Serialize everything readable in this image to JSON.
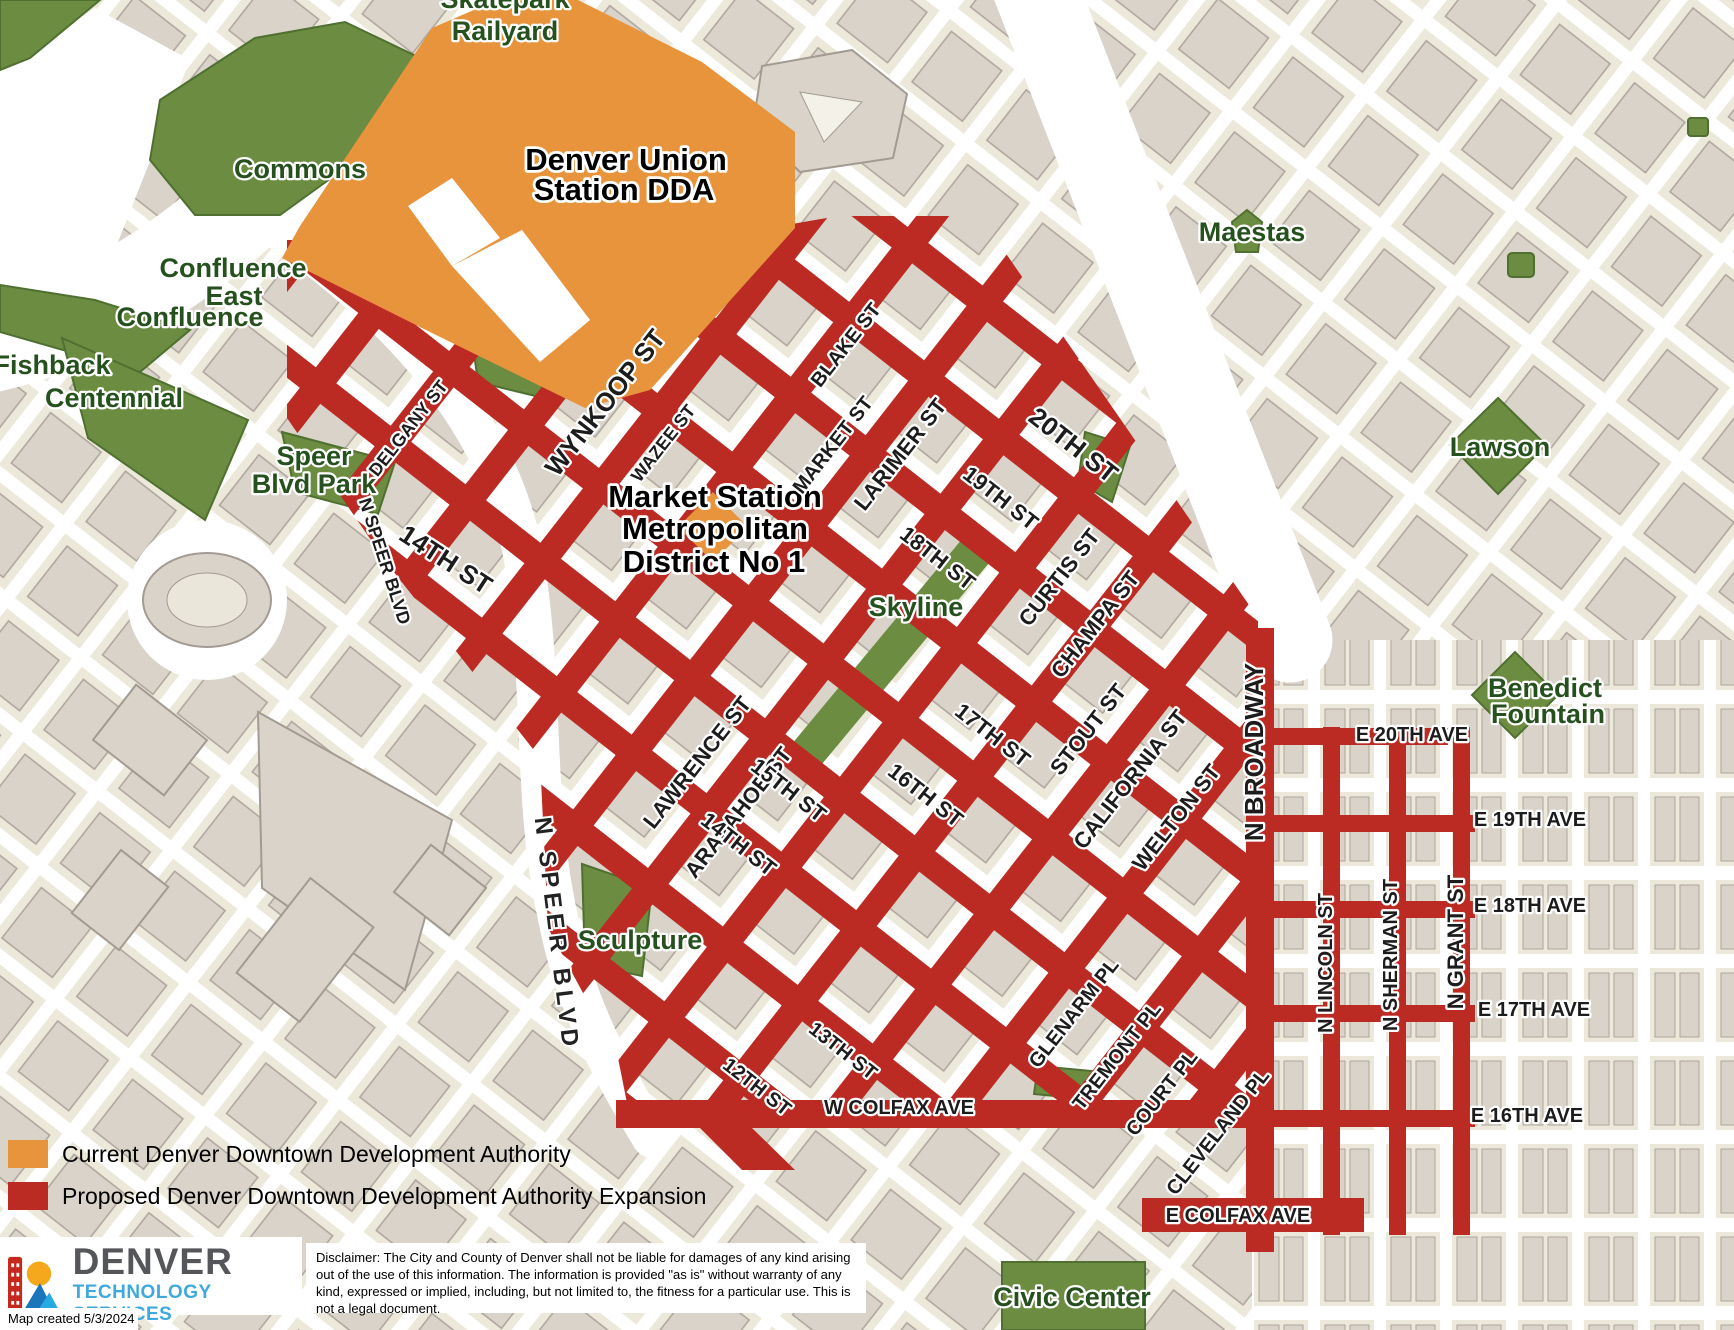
{
  "map": {
    "district_labels": [
      "Denver Union",
      "Station DDA",
      "Market Station",
      "Metropolitan",
      "District No 1"
    ],
    "area_labels": [
      "Skatepark",
      "Railyard",
      "Commons",
      "Confluence",
      "East",
      "Confluence",
      "Fishback",
      "Centennial",
      "Speer",
      "Blvd Park",
      "Maestas",
      "Lawson",
      "Benedict",
      "Fountain",
      "Skyline",
      "Sculpture",
      "Civic Center"
    ],
    "street_labels": [
      "DELGANY ST",
      "WYNKOOP ST",
      "WAZEE ST",
      "BLAKE ST",
      "MARKET ST",
      "LARIMER ST",
      "LAWRENCE ST",
      "ARAPAHOE ST",
      "CURTIS ST",
      "CHAMPA ST",
      "STOUT ST",
      "CALIFORNIA ST",
      "WELTON ST",
      "GLENARM PL",
      "TREMONT PL",
      "COURT PL",
      "CLEVELAND PL",
      "20TH ST",
      "19TH ST",
      "18TH ST",
      "17TH ST",
      "16TH ST",
      "15TH ST",
      "14TH ST",
      "13TH ST",
      "12TH ST",
      "14TH ST",
      "N SPEER BLVD",
      "W COLFAX AVE",
      "E COLFAX AVE",
      "N BROADWAY",
      "N LINCOLN ST",
      "N SHERMAN ST",
      "N GRANT ST",
      "E 20TH AVE",
      "E 19TH AVE",
      "E 18TH AVE",
      "E 17TH AVE",
      "E 16TH AVE",
      "N SPEER BLVD"
    ],
    "colors": {
      "current_dda": "#E8943D",
      "proposed_expansion": "#BB2B24",
      "park_green": "#6B8C41",
      "block_beige": "#ECE9DB",
      "building_gray": "#D9D3C9"
    }
  },
  "legend": {
    "items": [
      {
        "label": "Current Denver Downtown Development Authority",
        "color": "#E8943D"
      },
      {
        "label": "Proposed Denver Downtown Development Authority Expansion",
        "color": "#BB2B24"
      }
    ]
  },
  "footer": {
    "org": "DENVER",
    "dept": "TECHNOLOGY SERVICES",
    "disclaimer": "Disclaimer: The City and County of Denver shall not be liable for damages of any kind arising out of the use of this information. The information is provided \"as is\" without warranty of any kind, expressed or implied, including, but not limited to, the fitness for a particular use. This is not a legal document.",
    "created": "Map created 5/3/2024"
  }
}
